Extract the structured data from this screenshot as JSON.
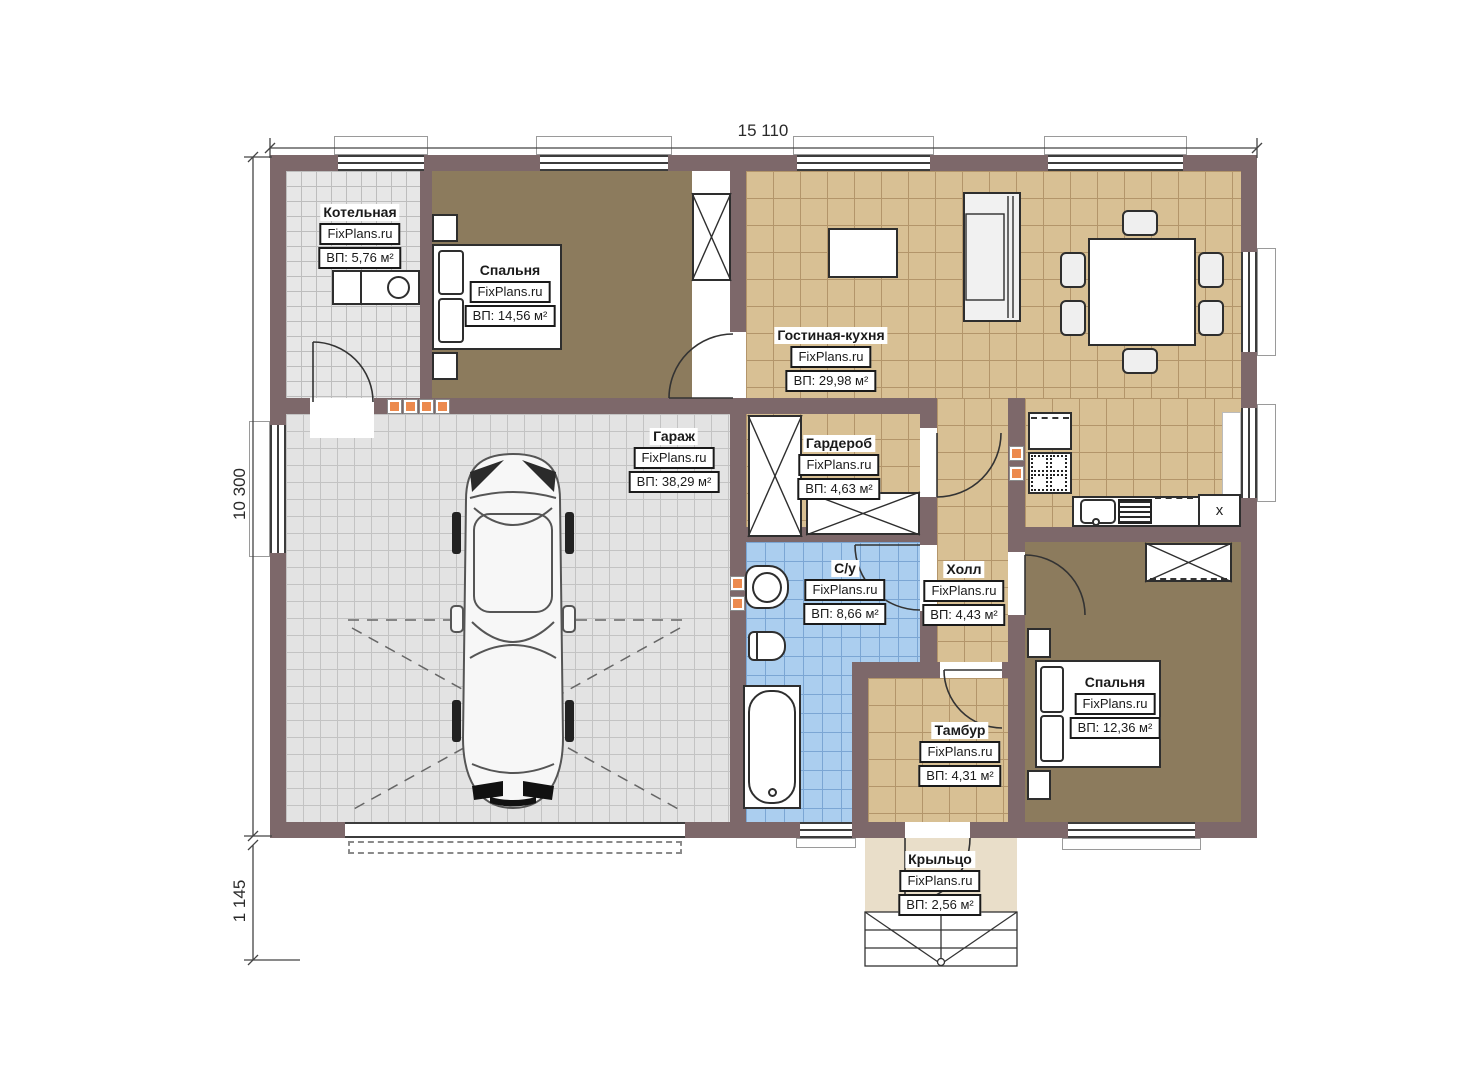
{
  "dimensions": {
    "top": "15 110",
    "left": "10 300",
    "left_bottom": "1 145"
  },
  "rooms": [
    {
      "name": "Котельная",
      "brand": "FixPlans.ru",
      "area": "ВП: 5,76 м²"
    },
    {
      "name": "Спальня",
      "brand": "FixPlans.ru",
      "area": "ВП: 14,56 м²"
    },
    {
      "name": "Гостиная-кухня",
      "brand": "FixPlans.ru",
      "area": "ВП: 29,98 м²"
    },
    {
      "name": "Гараж",
      "brand": "FixPlans.ru",
      "area": "ВП: 38,29 м²"
    },
    {
      "name": "Гардероб",
      "brand": "FixPlans.ru",
      "area": "ВП: 4,63 м²"
    },
    {
      "name": "С/у",
      "brand": "FixPlans.ru",
      "area": "ВП: 8,66 м²"
    },
    {
      "name": "Холл",
      "brand": "FixPlans.ru",
      "area": "ВП: 4,43 м²"
    },
    {
      "name": "Тамбур",
      "brand": "FixPlans.ru",
      "area": "ВП: 4,31 м²"
    },
    {
      "name": "Спальня",
      "brand": "FixPlans.ru",
      "area": "ВП: 12,36 м²"
    },
    {
      "name": "Крыльцо",
      "brand": "FixPlans.ru",
      "area": "ВП: 2,56 м²"
    }
  ],
  "kitchen": {
    "appliance_mark": "x"
  },
  "colors": {
    "wall": "#7d686a",
    "floor_wood": "#8c7b5d",
    "tile_beige": "#d8c094",
    "tile_gray": "#e4e4e4",
    "tile_blue": "#abceef",
    "porch": "#e9dec9",
    "accent_orange": "#ec8a4e"
  }
}
